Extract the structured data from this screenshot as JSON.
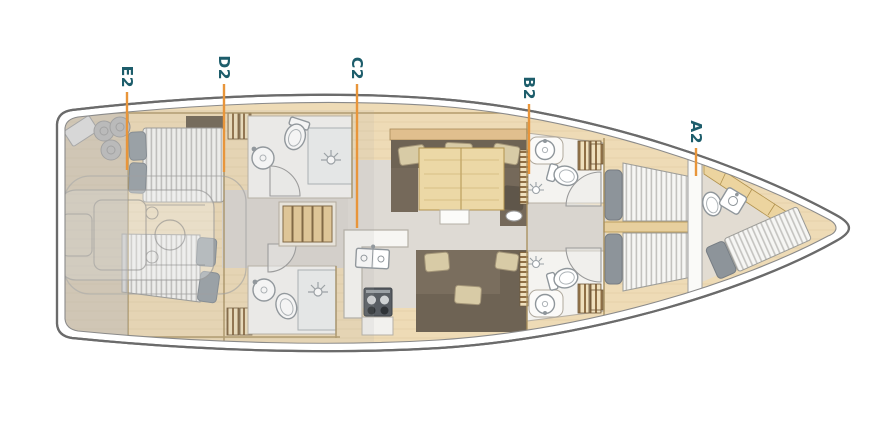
{
  "diagram": {
    "kind": "sailing-yacht-interior-deck-plan",
    "labels": [
      {
        "id": "E2",
        "points_to": "aft-cabins-zone"
      },
      {
        "id": "D2",
        "points_to": "mid-heads-zone"
      },
      {
        "id": "C2",
        "points_to": "saloon-galley-zone"
      },
      {
        "id": "B2",
        "points_to": "forward-heads-zone"
      },
      {
        "id": "A2",
        "points_to": "bow-crew-cabin-zone"
      }
    ],
    "colors": {
      "label_text": "#1d5d6b",
      "leader_line": "#e8953a",
      "hull_outline": "#6b6b6b",
      "deck_wood": "#eedbb6",
      "wood_trim": "#e0bf8e",
      "cabin_floor": "#dcd8d2",
      "bathroom_floor": "#f4f3f0",
      "sofa_brown": "#6e6354",
      "sofa_seat": "#7a6e5e",
      "cushion_beige": "#d8cba6",
      "pillow_gray": "#98a0a6",
      "mattress_white": "#f6f6f4",
      "stern_overlay_gray": "#b9b9b9"
    },
    "features": [
      "stern-garage",
      "engine-ghost",
      "aft-double-bed-port",
      "aft-double-bed-starboard",
      "head-with-shower-port",
      "head-with-shower-starboard",
      "companionway-steps",
      "galley-sink-stove",
      "u-sofa-with-table",
      "port-settee",
      "forward-head-port",
      "forward-head-starboard",
      "owner-twin-beds",
      "crew-berth",
      "crew-toilet",
      "crew-sink"
    ]
  }
}
